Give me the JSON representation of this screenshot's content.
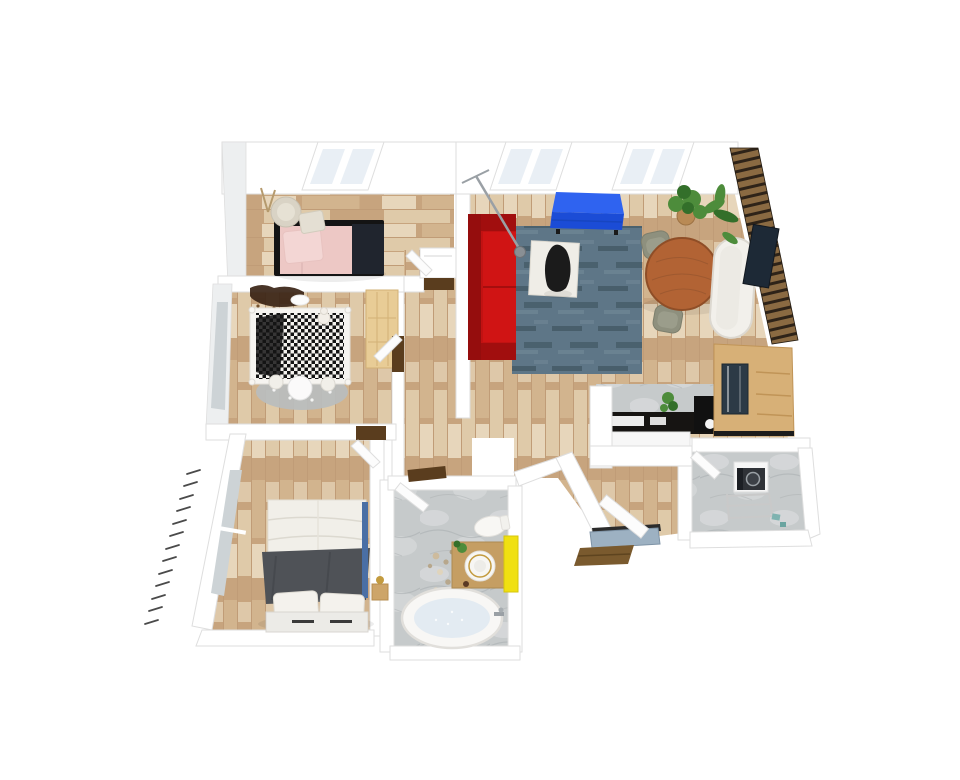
{
  "title": "3D apartment floor plan - top view render",
  "palette": {
    "wall": "#ffffff",
    "wall-edge": "#dedede",
    "wall-face": "#edeff0",
    "floor-wood": "#c7a47e",
    "plank-mid": "#d2b48e",
    "plank-light": "#dfcaa9",
    "plank-pale": "#ecdfc6",
    "plank-line": "#b08f69",
    "marble": "#c6cacb",
    "marble-light": "#d7dadb",
    "marble-dark": "#a8adaf",
    "glass": "#e9eff5",
    "glass-gray": "#cdd3d6",
    "threshold-wood": "#5a3d1e",
    "sofa-red": "#c11212",
    "sofa-red-dark": "#950d0d",
    "sofa-red-mid": "#d01414",
    "rug-blue": "#5e7687",
    "rug-dark": "#31464f",
    "rug-light": "#7d93a1",
    "dresser-blue": "#1b4cd6",
    "dresser-blue-top": "#2f63f0",
    "bed-pink": "#edc8c5",
    "pillow-pink": "#f3d6d4",
    "black": "#141414",
    "navy": "#20252e",
    "duvet": "#f1efe9",
    "blanket-gray": "#4f5257",
    "linen-line": "#dcd9d0",
    "table-wood": "#b26334",
    "table-rim": "#8f4e27",
    "grain": "#9e5930",
    "chair-gray": "#8e907e",
    "chair-light": "#9b9d8b",
    "sofa-white": "#f2f0eb",
    "sofa-white-line": "#dcd8d0",
    "tv-dark": "#1d2936",
    "slat-wood": "#8a6a42",
    "slat-gap": "#2e2318",
    "cabinet-wood": "#d7b077",
    "cabinet-edge": "#c09457",
    "wardrobe-wood": "#e8cc96",
    "wardrobe-edge": "#d2b176",
    "counter-black": "#161412",
    "fridge-glass": "#2c3a46",
    "plant-green": "#4d8c3b",
    "plant-dark": "#336f2a",
    "pot-brown": "#b98a55",
    "vanity-wood": "#c59e63",
    "vanity-edge": "#ad8951",
    "cabinet-yellow": "#f0e011",
    "yellow-edge": "#d6c60d",
    "water": "#e3ebf2",
    "tub-edge": "#e1dfdb",
    "mat-blue": "#9db1c2",
    "mat-edge": "#7e93a6",
    "step-wood": "#7a5a2e",
    "step-line": "#5e441f",
    "rug-gray": "#b9bdbd",
    "gold": "#c39b3f",
    "metal": "#9aa0a5",
    "washer-front": "#2f3237",
    "teal": "#7fb3b0",
    "mural-brown": "#3a2416",
    "mural-dot": "#7a5530",
    "runner-blue": "#4a6fa5",
    "crib-white": "#f6f4f0"
  },
  "scene": {
    "type": "3d-floor-plan-top-view",
    "rooms": [
      {
        "id": "bedroom",
        "furniture": [
          "double-bed-pink",
          "black-bed-base",
          "navy-throw",
          "armchair",
          "ottoman",
          "tripod-lamp",
          "closet-nook",
          "skylight-window"
        ]
      },
      {
        "id": "nursery",
        "furniture": [
          "crib-checkered",
          "teddy-bear",
          "kids-table",
          "stools",
          "play-rug",
          "wardrobe",
          "wall-mural",
          "ceiling-light",
          "window"
        ]
      },
      {
        "id": "master-bedroom",
        "furniture": [
          "double-bed-gray",
          "white-pillows",
          "storage-bench",
          "nightstand",
          "gold-lamp",
          "blue-runner",
          "window-wall",
          "balcony-railing",
          "door"
        ]
      },
      {
        "id": "bathroom",
        "furniture": [
          "bathtub",
          "faucet",
          "vanity",
          "round-sink-gold-rim",
          "yellow-cabinet",
          "toilet",
          "pebble-mat",
          "plant",
          "door"
        ]
      },
      {
        "id": "living-room",
        "furniture": [
          "red-sofa",
          "blue-rug",
          "white-mat",
          "black-lounge-chair",
          "arc-floor-lamp",
          "blue-sideboard",
          "round-dining-table",
          "dining-chair",
          "dining-chair",
          "white-curved-sofa",
          "tv",
          "slat-accent-wall",
          "potted-plants",
          "skylight-windows"
        ]
      },
      {
        "id": "kitchen",
        "furniture": [
          "marble-backsplash",
          "black-countertop",
          "white-cabinet-front",
          "counter-plant",
          "cooktop-block",
          "tall-wood-cabinet",
          "glass-fridge"
        ]
      },
      {
        "id": "hallway",
        "furniture": [
          "door-thresholds"
        ]
      },
      {
        "id": "entry",
        "furniture": [
          "front-door",
          "doormat",
          "wooden-step"
        ]
      },
      {
        "id": "utility-room",
        "furniture": [
          "washing-machine",
          "drying-rack",
          "laundry-items",
          "door"
        ]
      }
    ]
  }
}
